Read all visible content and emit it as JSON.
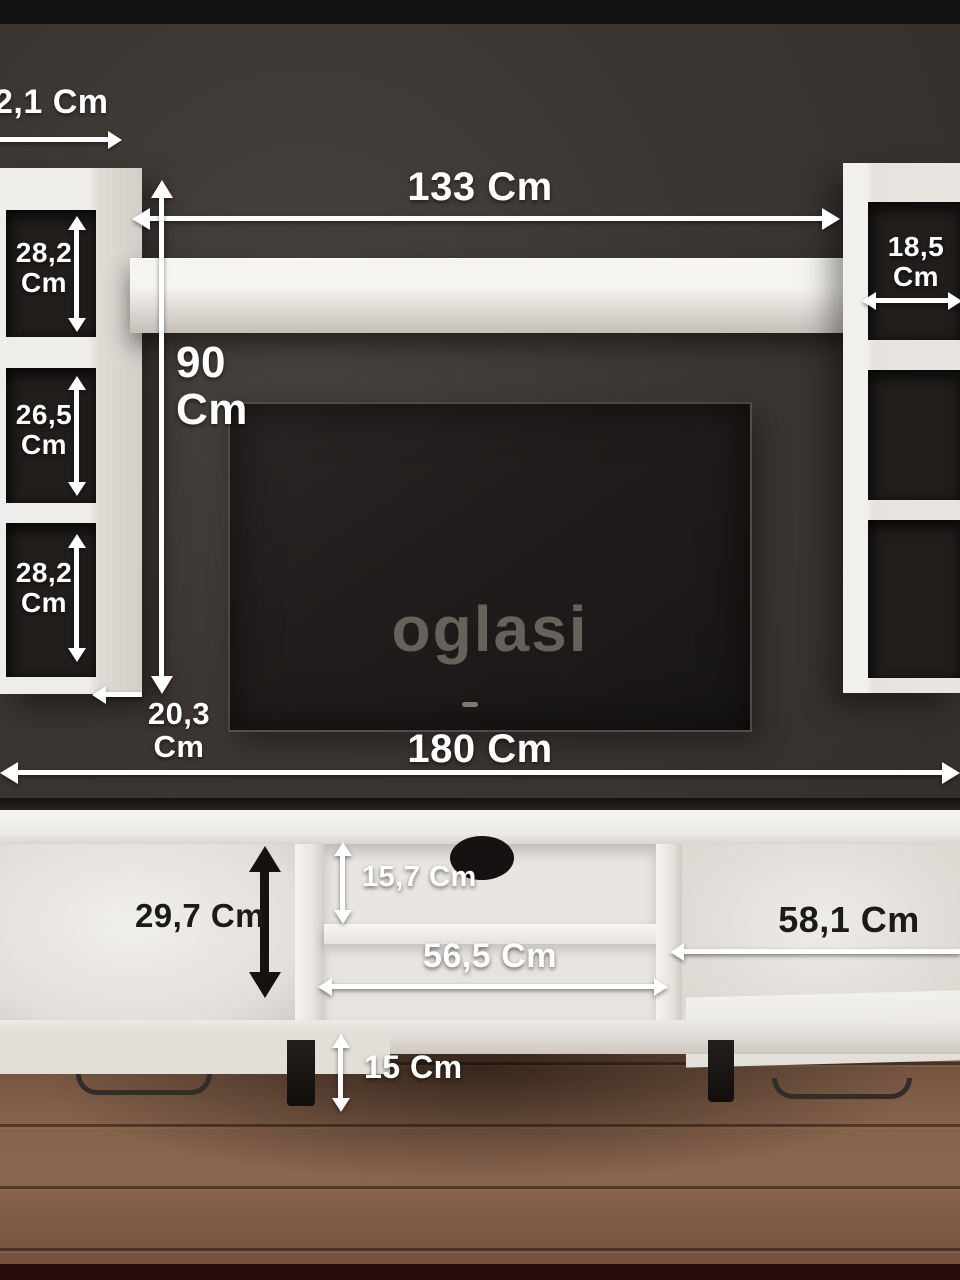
{
  "watermark": "oglasi",
  "measurements": {
    "top_depth": "2,1 Cm",
    "shelf_width": "133 Cm",
    "unit_height": "90\nCm",
    "left_top": "28,2\nCm",
    "left_middle": "26,5\nCm",
    "left_bottom": "28,2\nCm",
    "left_depth": "20,3 Cm",
    "right_width": "18,5\nCm",
    "total_width": "180 Cm",
    "base_left_height": "29,7 Cm",
    "base_shelf_height": "15,7 Cm",
    "base_middle_width": "56,5 Cm",
    "base_right_width": "58,1 Cm",
    "leg_height": "15 Cm"
  },
  "colors": {
    "wall": "#3a3531",
    "furniture_white": "#e9e6e1",
    "tv_screen": "#201d1c",
    "floor_brown": "#7b5a43",
    "label_white": "#ffffff",
    "label_black": "#1c1b1a",
    "watermark_gray": "#6e6962"
  }
}
